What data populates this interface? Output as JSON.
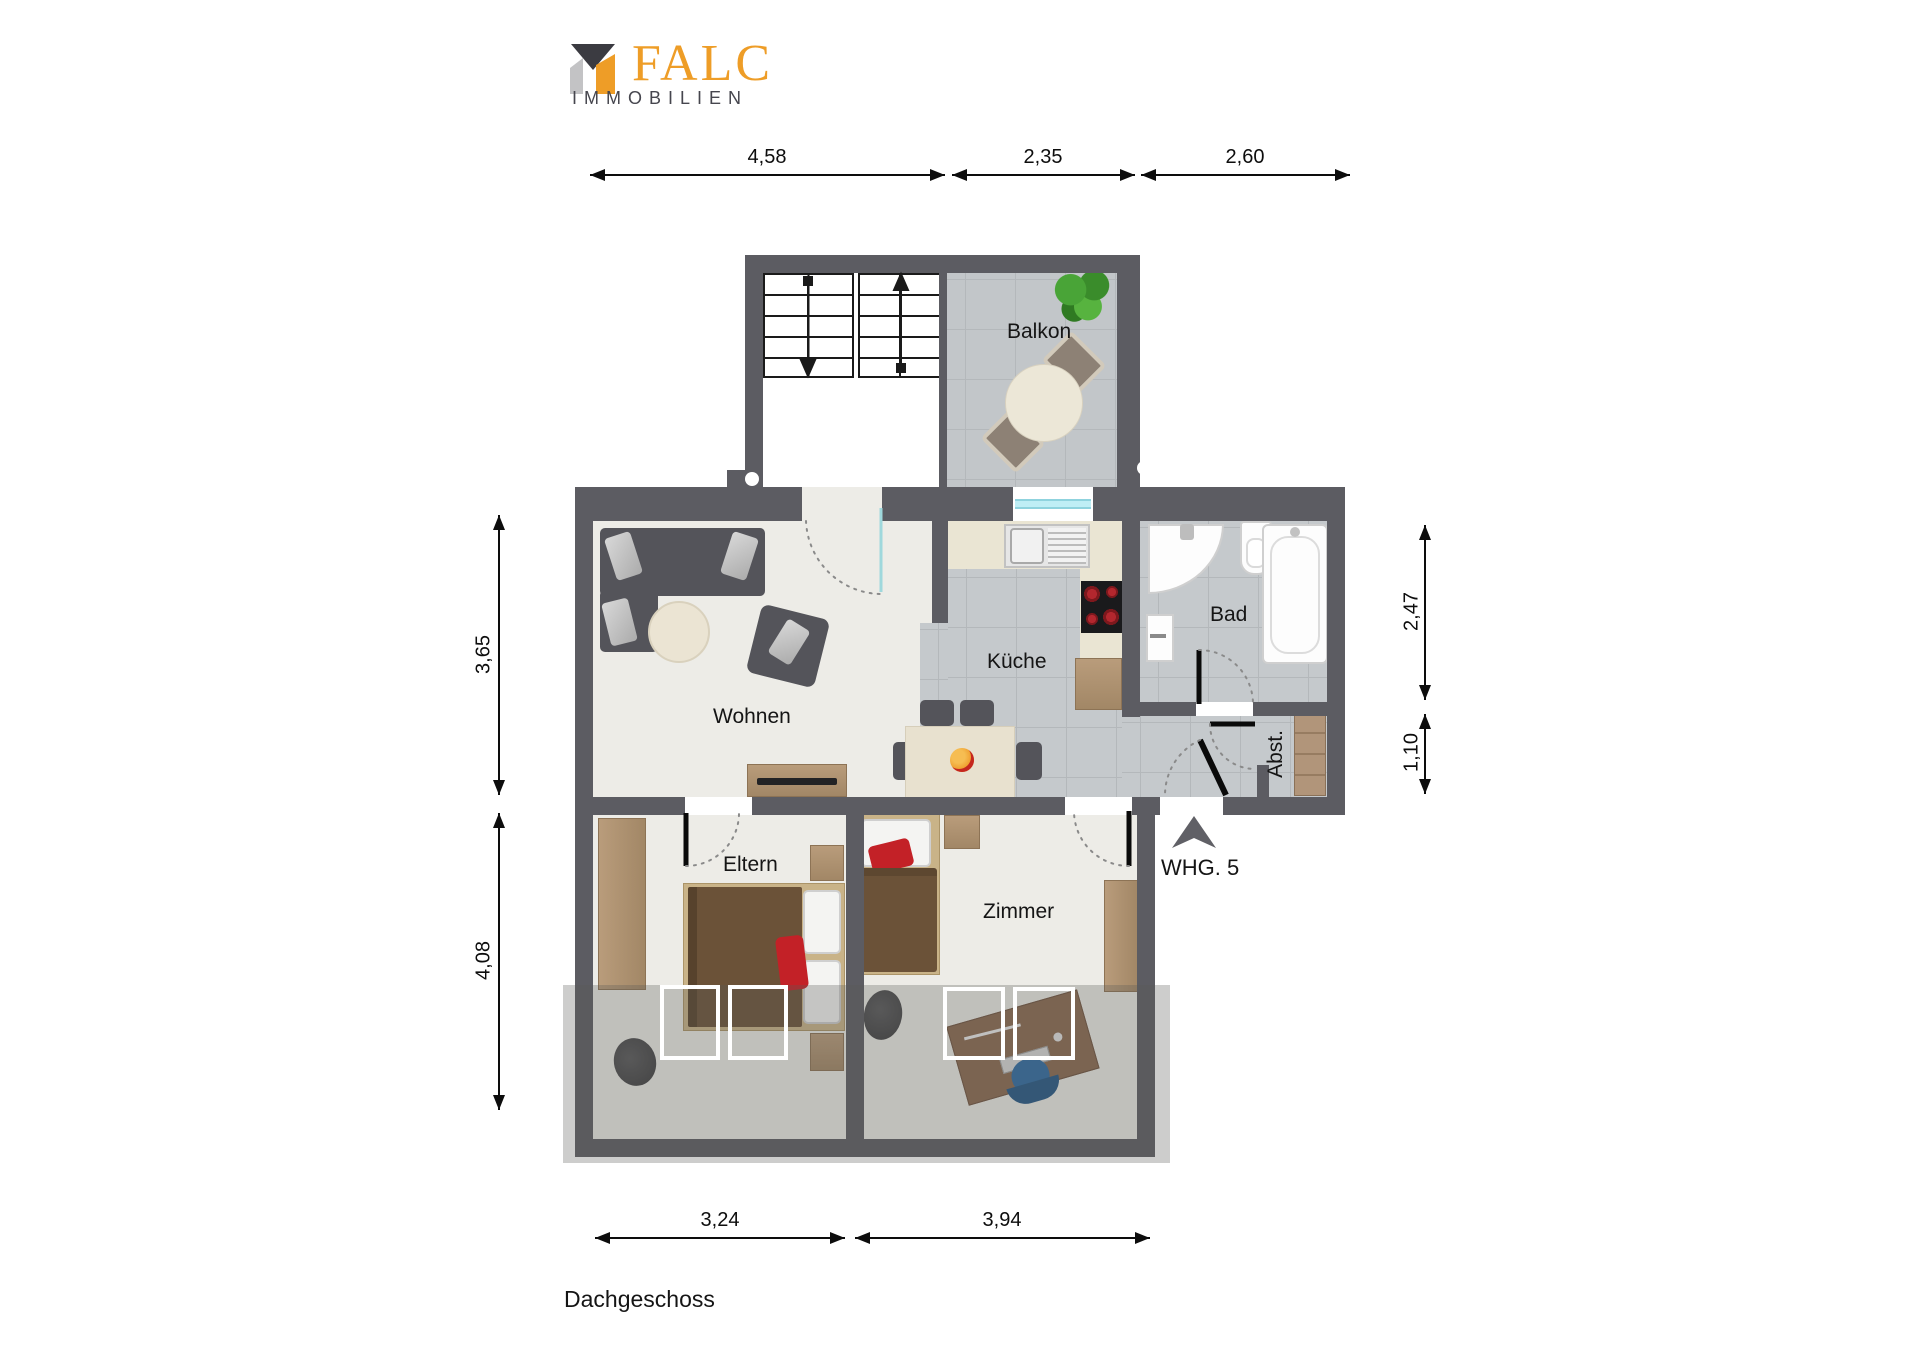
{
  "header": {
    "brand": "FALC",
    "subtitle": "IMMOBILIEN"
  },
  "plan": {
    "rooms": [
      {
        "id": "balkon",
        "label": "Balkon"
      },
      {
        "id": "wohnen",
        "label": "Wohnen"
      },
      {
        "id": "kueche",
        "label": "Küche"
      },
      {
        "id": "bad",
        "label": "Bad"
      },
      {
        "id": "abst",
        "label": "Abst."
      },
      {
        "id": "eltern",
        "label": "Eltern"
      },
      {
        "id": "zimmer",
        "label": "Zimmer"
      }
    ],
    "entrance_label": "WHG. 5",
    "floor_label": "Dachgeschoss"
  },
  "dimensions": {
    "top": [
      {
        "label": "4,58"
      },
      {
        "label": "2,35"
      },
      {
        "label": "2,60"
      }
    ],
    "left": [
      {
        "label": "3,65"
      },
      {
        "label": "4,08"
      }
    ],
    "right": [
      {
        "label": "2,47"
      },
      {
        "label": "1,10"
      }
    ],
    "bottom": [
      {
        "label": "3,24"
      },
      {
        "label": "3,94"
      }
    ]
  },
  "colors": {
    "wall": "#5c5c62",
    "floor": "#edece7",
    "tile": "#c5c9cc",
    "brand_orange": "#ee9d27",
    "logo_dark": "#3b3b41",
    "logo_gray": "#c3c3c5",
    "accent_red": "#c32127",
    "wood": "#b1957a",
    "window_blue": "#bfeef5"
  }
}
